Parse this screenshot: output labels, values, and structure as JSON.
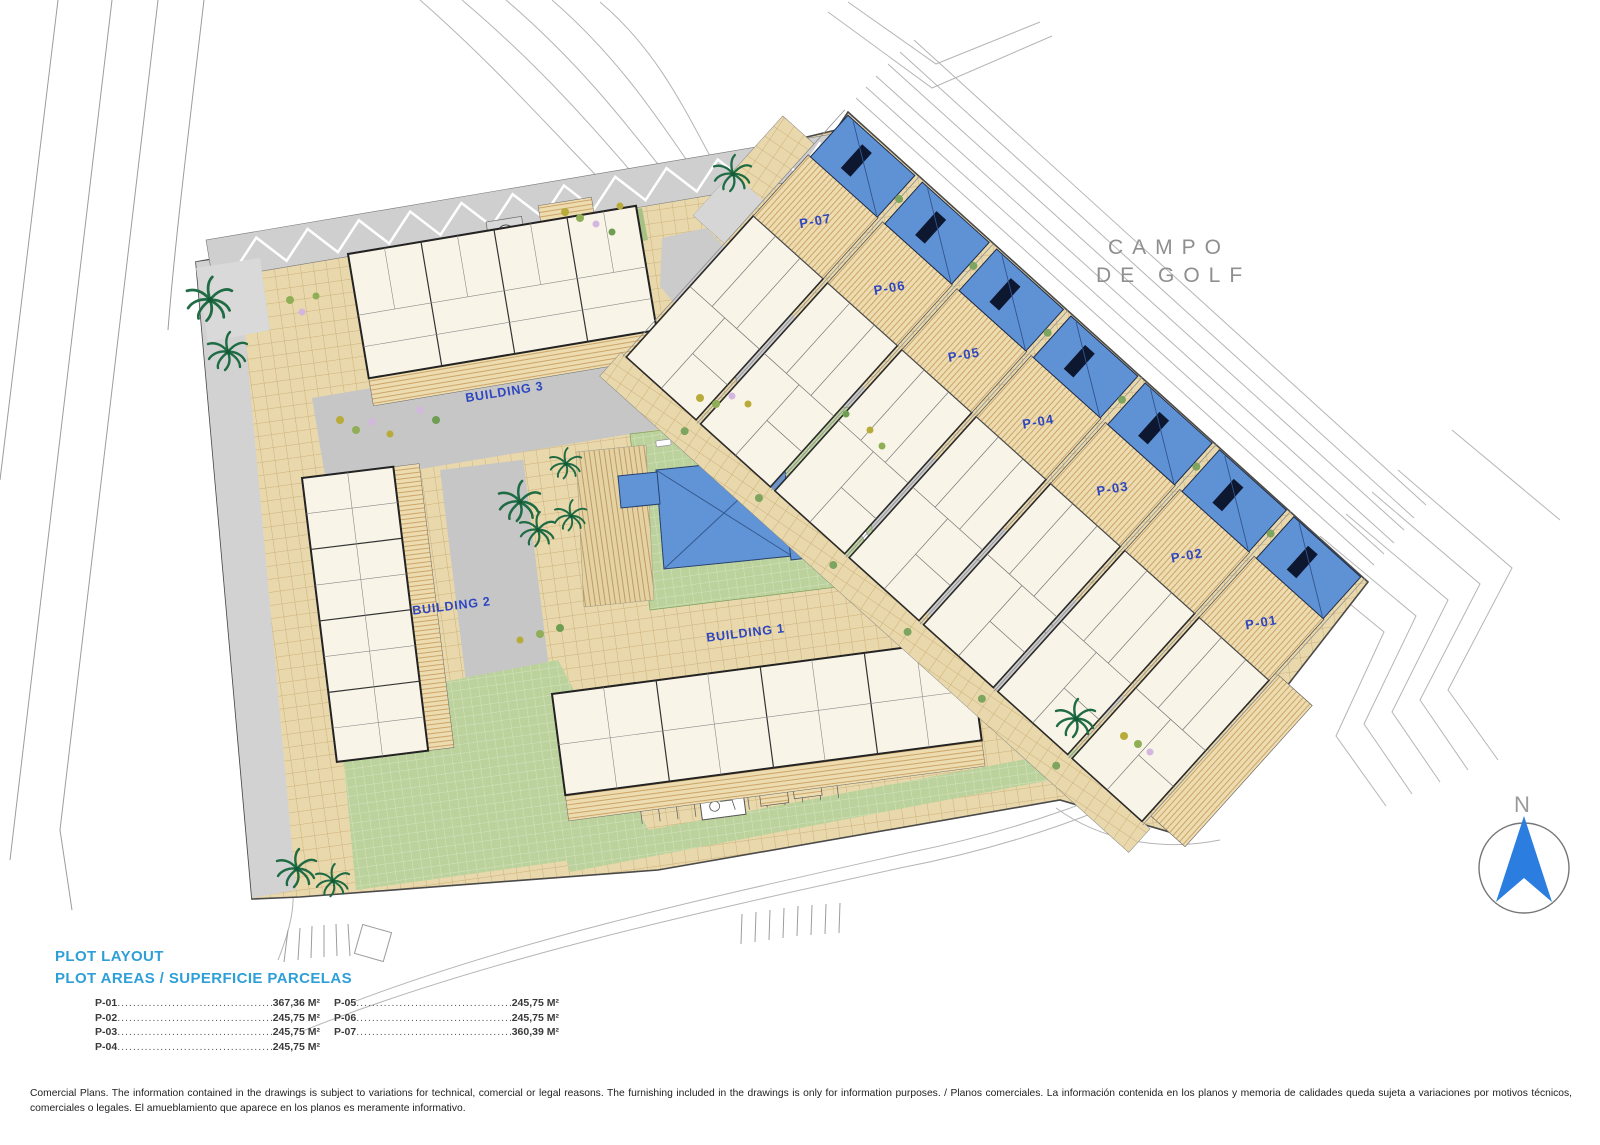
{
  "plan": {
    "golf_area_label": {
      "line1": "CAMPO",
      "line2": "DE GOLF"
    },
    "north_label": "N",
    "buildings": [
      {
        "label": "BUILDING 3"
      },
      {
        "label": "BUILDING 2"
      },
      {
        "label": "BUILDING 1"
      }
    ],
    "villas": [
      {
        "label": "P-07"
      },
      {
        "label": "P-06"
      },
      {
        "label": "P-05"
      },
      {
        "label": "P-04"
      },
      {
        "label": "P-03"
      },
      {
        "label": "P-02"
      },
      {
        "label": "P-01"
      }
    ]
  },
  "legend": {
    "title": "PLOT LAYOUT",
    "subtitle": "PLOT AREAS / SUPERFICIE PARCELAS",
    "plots": [
      {
        "id": "P-01",
        "area": "367,36 M²"
      },
      {
        "id": "P-02",
        "area": "245,75 M²"
      },
      {
        "id": "P-03",
        "area": "245,75 M²"
      },
      {
        "id": "P-04",
        "area": "245,75 M²"
      },
      {
        "id": "P-05",
        "area": "245,75 M²"
      },
      {
        "id": "P-06",
        "area": "245,75 M²"
      },
      {
        "id": "P-07",
        "area": "360,39 M²"
      }
    ]
  },
  "footer": {
    "disclaimer": "Comercial Plans. The information contained in the drawings is subject to variations for technical, comercial or legal reasons. The furnishing included in the drawings is only for information purposes. / Planos comerciales. La información contenida en los planos y memoria de calidades queda sujeta a variaciones por motivos técnicos, comerciales o legales. El amueblamiento que aparece en los planos es meramente informativo."
  },
  "colors": {
    "label_blue": "#2e46c0",
    "legend_blue": "#2f9fd8",
    "pool_blue": "#5f92d5",
    "lawn_green": "#bcd29c",
    "paving_tan": "#e9d8ab",
    "terrace_tan": "#ecdcb0",
    "road_gray": "#cfcfcf",
    "contour_gray": "#b5b5b5"
  }
}
